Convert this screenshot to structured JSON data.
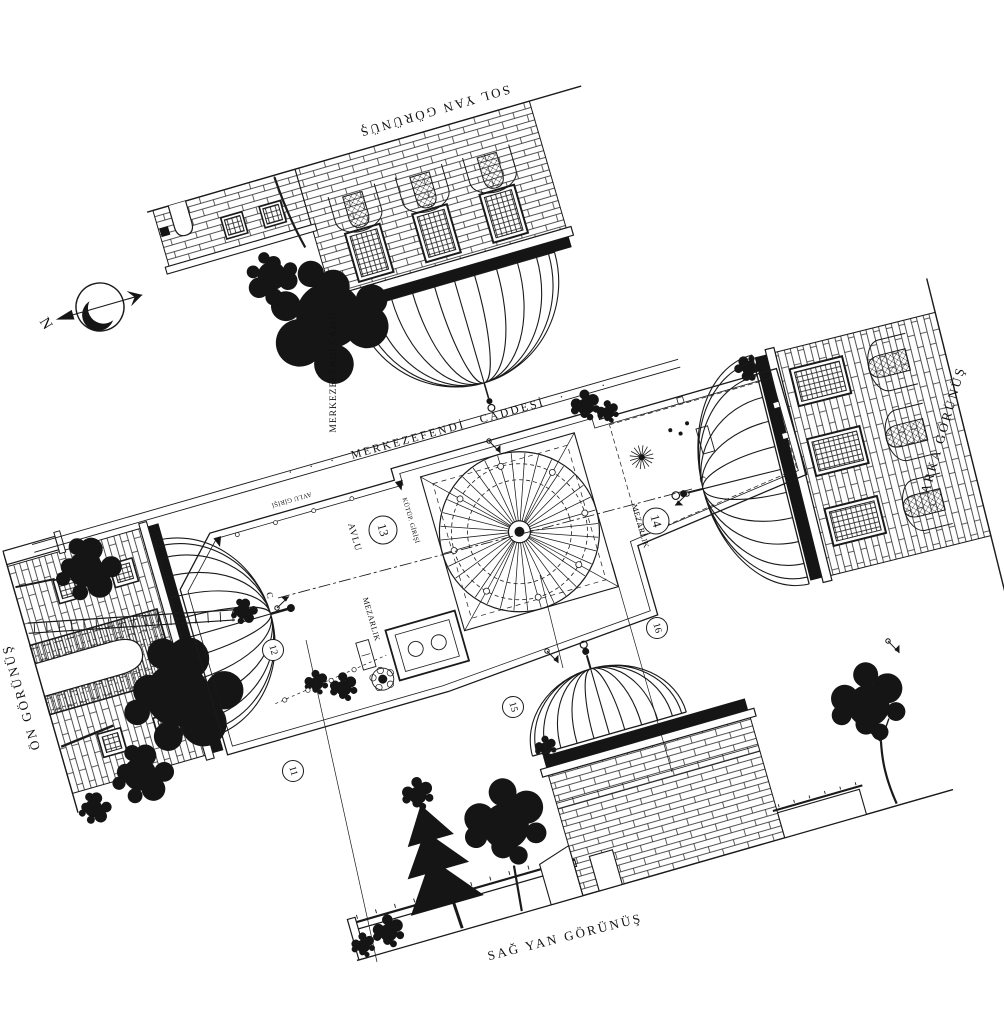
{
  "labels": {
    "view_top": "SOL YAN GÖRÜNÜŞ",
    "view_front": "ÖN GÖRÜNÜŞ",
    "view_back": "ARKA GÖRÜNÜŞ",
    "view_bottom": "SAĞ YAN GÖRÜNÜŞ",
    "building": "MERKEZEFENDİ CAMİİ",
    "street": "· · ·  MERKEZEFENDİ  CADDESİ  · · ·",
    "courtyard": "AVLU",
    "cemetery_left": "MEZARLIK",
    "cemetery_right": "MEZARLIK",
    "courtyard_entrance": "AVLU GİRİŞİ",
    "library_entrance": "KÜTÜP. GİRİŞİ",
    "north": "N",
    "section": "C"
  },
  "markers": {
    "m11": "11",
    "m12": "12",
    "m13": "13",
    "m14": "14",
    "m15": "15",
    "m16": "16"
  },
  "colors": {
    "ink": "#1a1a1a",
    "paper": "#ffffff"
  }
}
